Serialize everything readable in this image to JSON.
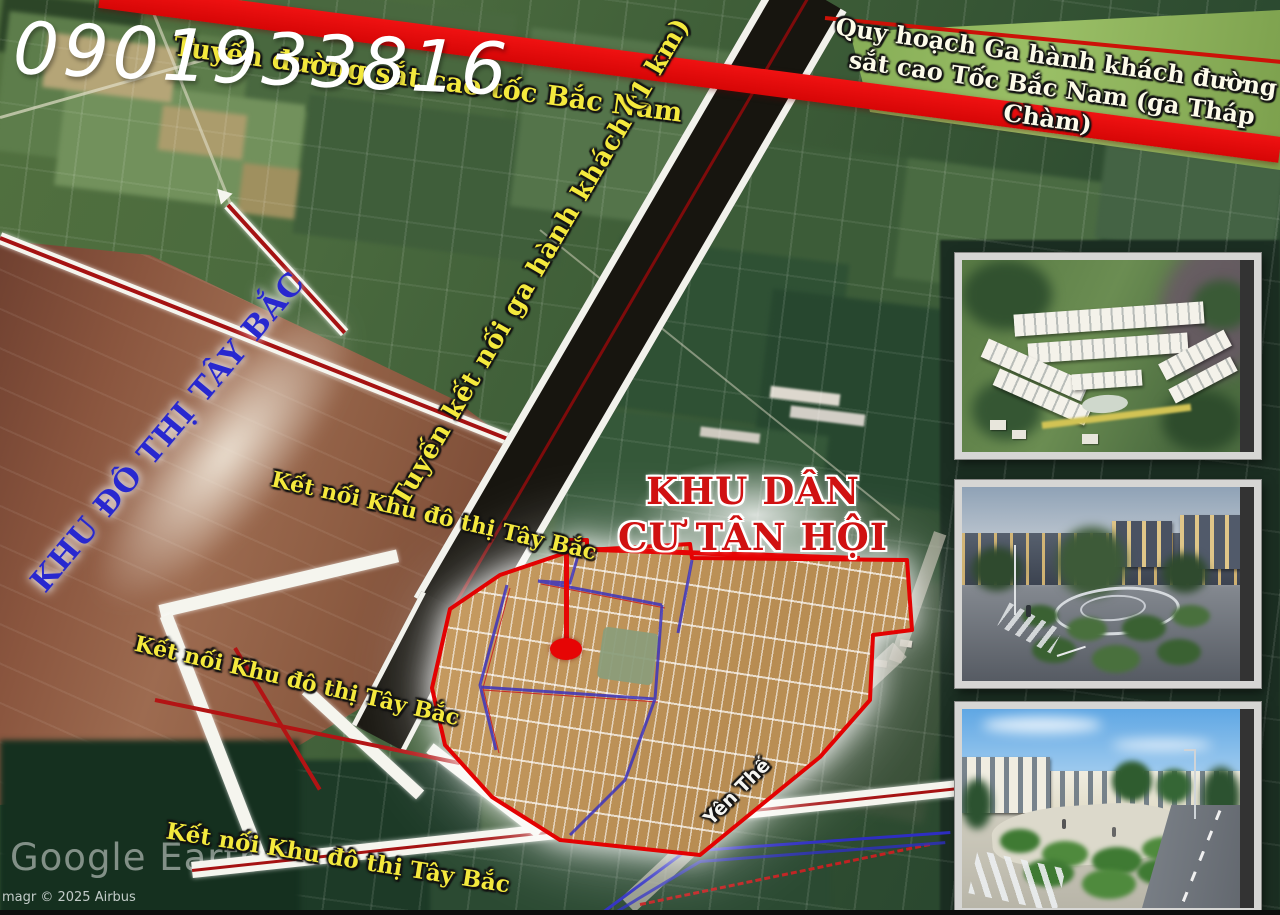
{
  "contact": {
    "phone_number": "0901933816"
  },
  "map": {
    "labels": {
      "railway_line": "Tuyến đường sắt cao tốc Bắc Nam",
      "station_plan": "Quy hoạch Ga hành khách đường sắt cao Tốc Bắc Nam (ga Tháp Chàm)",
      "connector_route": "Tuyến kết nối ga hành khách (1 km)",
      "taybac_zone": "KHU ĐÔ THỊ TÂY BẮC",
      "tanhoi_district": "KHU DÂN CƯ TÂN HỘI",
      "connect_taybac_1": "Kết nối Khu đô thị Tây Bắc",
      "connect_taybac_2": "Kết nối Khu đô thị Tây Bắc",
      "connect_taybac_3": "Kết nối Khu đô thị Tây Bắc",
      "street_yen_the": "Yên Thế"
    },
    "colors": {
      "railway_red": "#ed0b0b",
      "label_yellow": "#f4e93d",
      "zone_label_blue": "#2828cf",
      "district_label_red": "#d01111",
      "plot_boundary_red": "#e30202",
      "planned_road_blue": "#3d34bd",
      "taybac_zone_brown": "#8a553e"
    }
  },
  "watermark": {
    "brand": "Google Earth",
    "copyright": "magr © 2025 Airbus"
  },
  "insets": [
    {
      "name": "aerial-masterplan-render"
    },
    {
      "name": "dusk-central-park-render"
    },
    {
      "name": "daytime-streetscape-render"
    }
  ]
}
